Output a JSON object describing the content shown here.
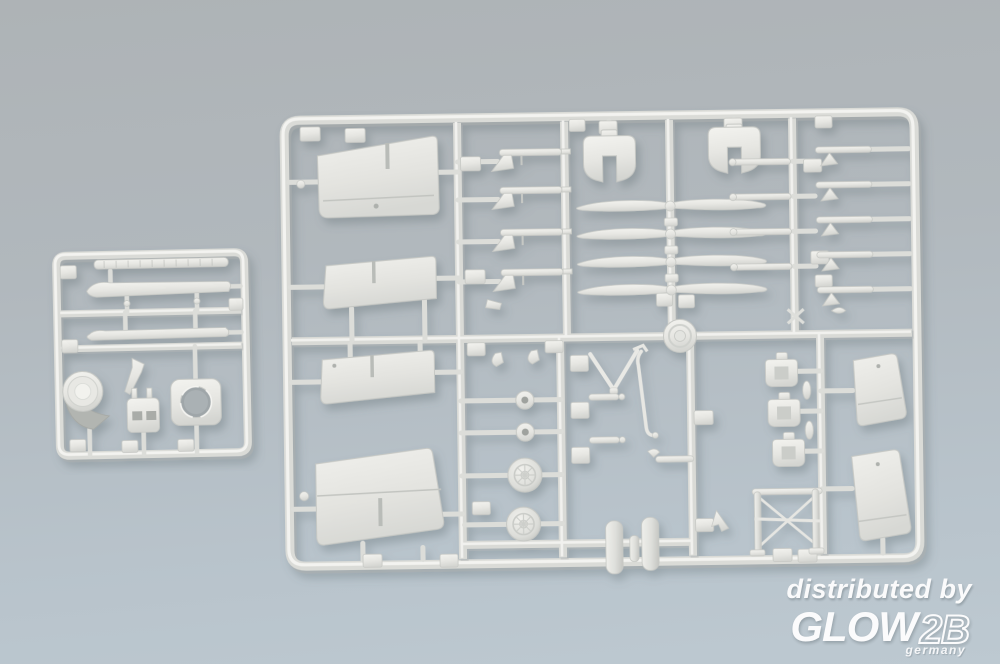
{
  "photo": {
    "subject": "Product photo of two silver-grey injection-molded plastic model kit sprues on a grey-blue background",
    "background_top_color": "#aeb3b6",
    "background_bottom_color": "#bdc9d1",
    "plastic_color": "#e9e9e5"
  },
  "watermark": {
    "distributed_by": "distributed by",
    "brand": "GLOW",
    "brand_suffix": "2B",
    "country": "germany",
    "text_color": "#ffffff"
  },
  "sprues": {
    "small": {
      "name": "small detail sprue",
      "parts": [
        "float-ski",
        "float-ski",
        "tread-strip",
        "engine-cowling-drum",
        "support-bracket",
        "pilot-seat",
        "cowl-ring"
      ]
    },
    "large": {
      "name": "main parts sprue",
      "parts": [
        "wing-half",
        "wing-half",
        "wing-half",
        "wing-half",
        "two-blade-propeller",
        "two-blade-propeller",
        "two-blade-propeller",
        "two-blade-propeller",
        "heart-shaped-gear-fairing",
        "heart-shaped-gear-fairing",
        "machine-gun",
        "machine-gun",
        "machine-gun",
        "machine-gun",
        "wheel-hub",
        "wheel-hub",
        "main-wheel",
        "main-wheel",
        "float-pontoon",
        "float-pontoon",
        "v-strut",
        "long-strut",
        "pilot-seat",
        "pilot-seat",
        "pilot-seat",
        "stabilizer-half",
        "stabilizer-half",
        "cabane-strut-frame",
        "rosette-boss",
        "rigging-small-parts"
      ]
    }
  }
}
